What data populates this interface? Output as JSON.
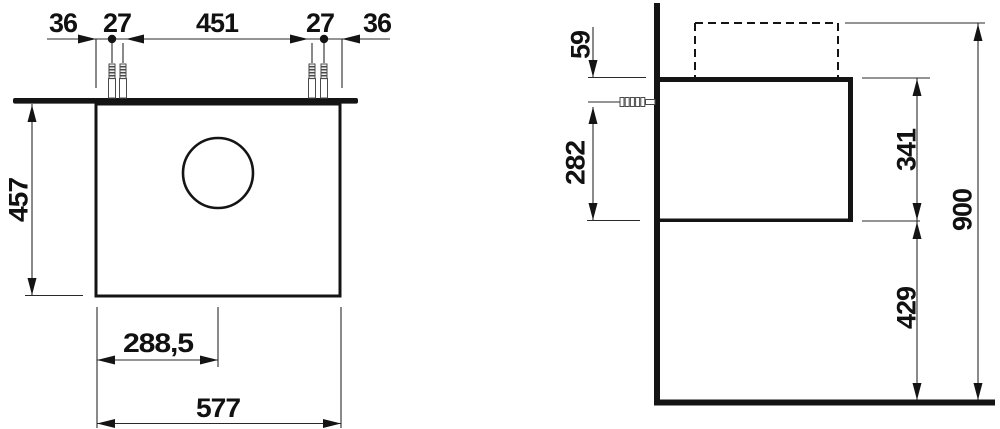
{
  "drawing_title": "vanity-unit-dimension-drawing",
  "line_color": "#141414",
  "front_view": {
    "top_dims": {
      "left_overhang": "36",
      "left_screw_offset": "27",
      "screw_span": "451",
      "right_screw_offset": "27",
      "right_overhang": "36"
    },
    "height": "457",
    "bottom_dims": {
      "center_offset": "288,5",
      "total_width": "577"
    }
  },
  "side_view": {
    "top_gap": "59",
    "screw_height": "282",
    "body_height": "341",
    "floor_clearance": "429",
    "total_height": "900"
  }
}
